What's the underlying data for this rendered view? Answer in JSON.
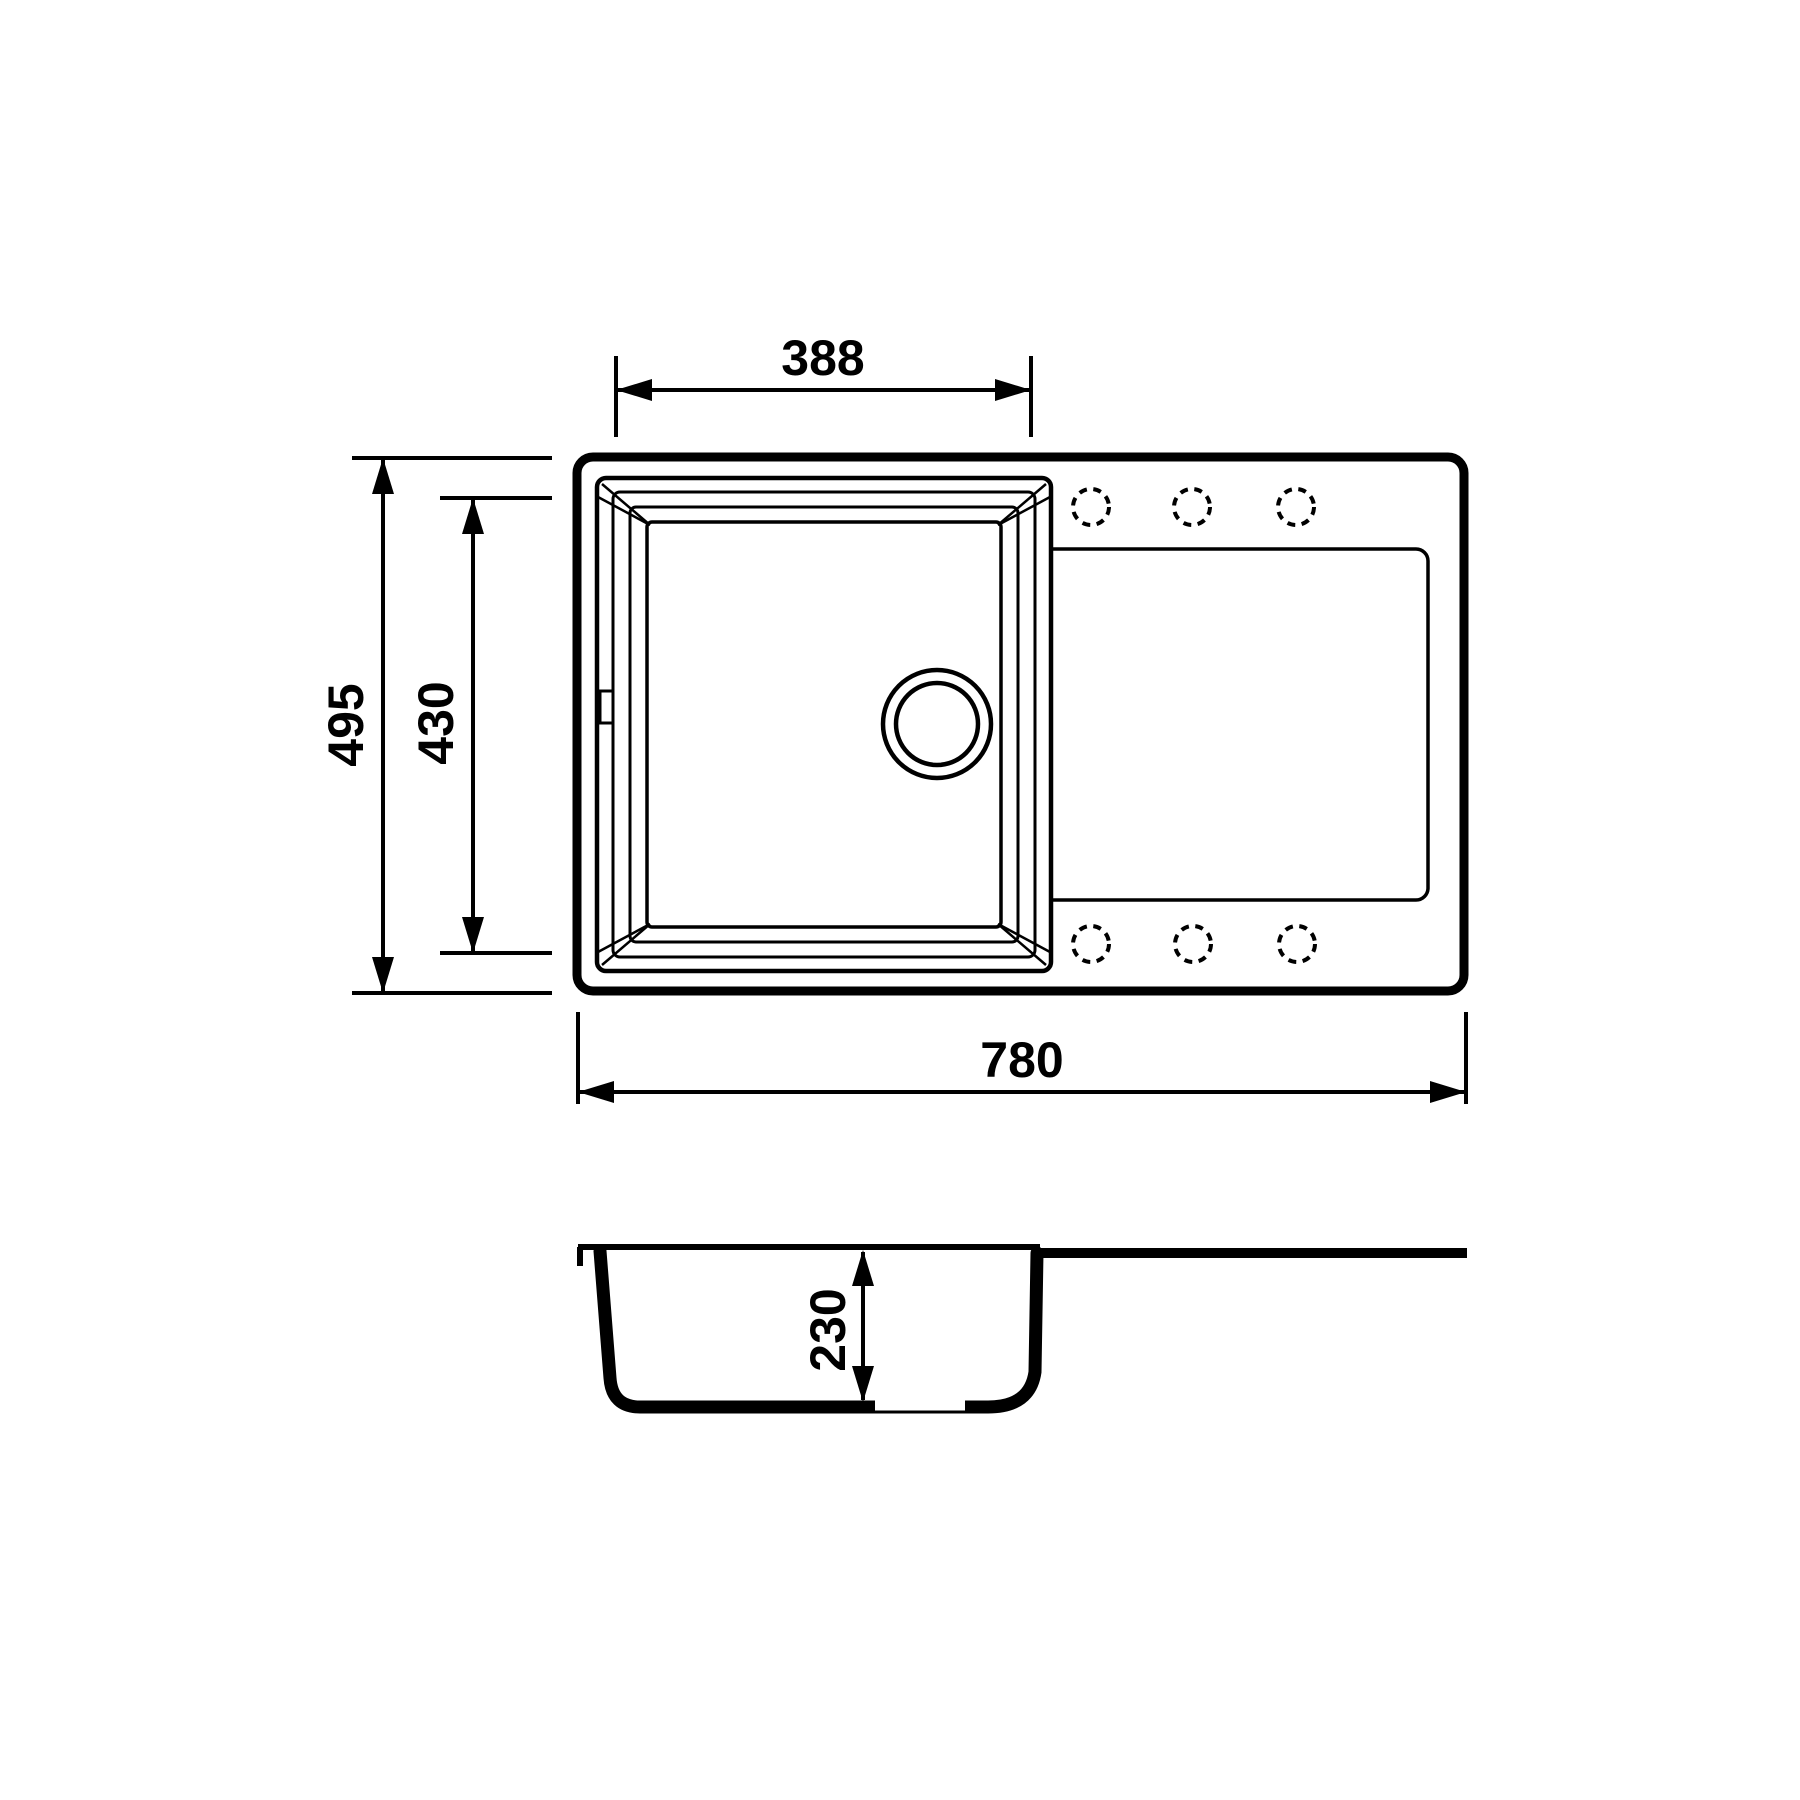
{
  "colors": {
    "background": "#ffffff",
    "line": "#000000"
  },
  "views": {
    "top": {
      "dimensions": {
        "bowl_width_label": "388",
        "overall_depth_label": "495",
        "bowl_depth_label": "430",
        "overall_width_label": "780"
      }
    },
    "section": {
      "dimensions": {
        "bowl_height_label": "230"
      }
    }
  }
}
